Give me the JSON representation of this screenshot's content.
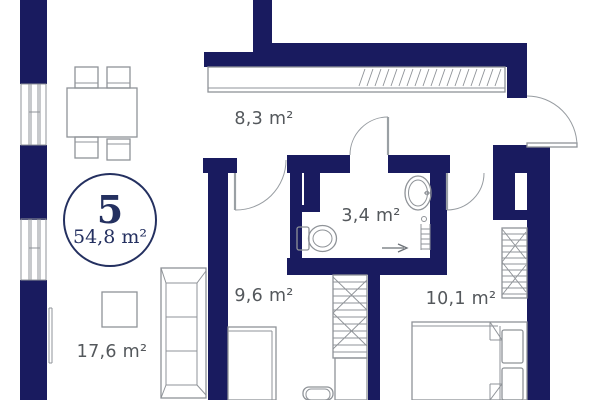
{
  "plan": {
    "badge": {
      "number": "5",
      "total_area": "54,8 m²"
    },
    "rooms": [
      {
        "name": "hallway",
        "area": "8,3 m²"
      },
      {
        "name": "bathroom",
        "area": "3,4 m²"
      },
      {
        "name": "bedroom-small",
        "area": "9,6 m²"
      },
      {
        "name": "bedroom-large",
        "area": "10,1 m²"
      },
      {
        "name": "living-room",
        "area": "17,6 m²"
      }
    ],
    "colors": {
      "wall": "#191b5f",
      "badge": "#243060",
      "label": "#54585c",
      "line": "#8f9398"
    }
  }
}
